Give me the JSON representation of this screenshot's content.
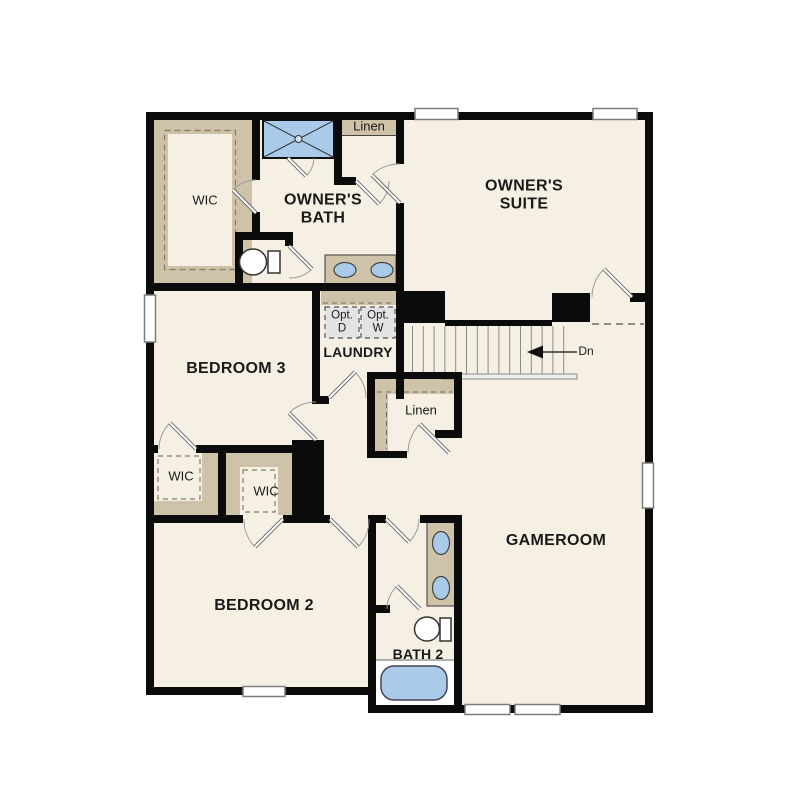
{
  "colors": {
    "floor": "#f6efe3",
    "closet_tan": "#cec2a8",
    "wall": "#0b0b0b",
    "fixture_blue": "#a9cae8",
    "appliance_gray": "#e3e3e3"
  },
  "labels": {
    "owners_suite": "OWNER'S\nSUITE",
    "owners_bath": "OWNER'S\nBATH",
    "wic_owner": "WIC",
    "linen_upper": "Linen",
    "bedroom3": "BEDROOM 3",
    "laundry": "LAUNDRY",
    "opt_dryer": "Opt.\nD",
    "opt_washer": "Opt.\nW",
    "stairs_down": "Dn",
    "linen_hall": "Linen",
    "wic_bedroom3": "WIC",
    "wic_bedroom2": "WIC",
    "bedroom2": "BEDROOM 2",
    "bath2": "BATH 2",
    "gameroom": "GAMEROOM"
  }
}
